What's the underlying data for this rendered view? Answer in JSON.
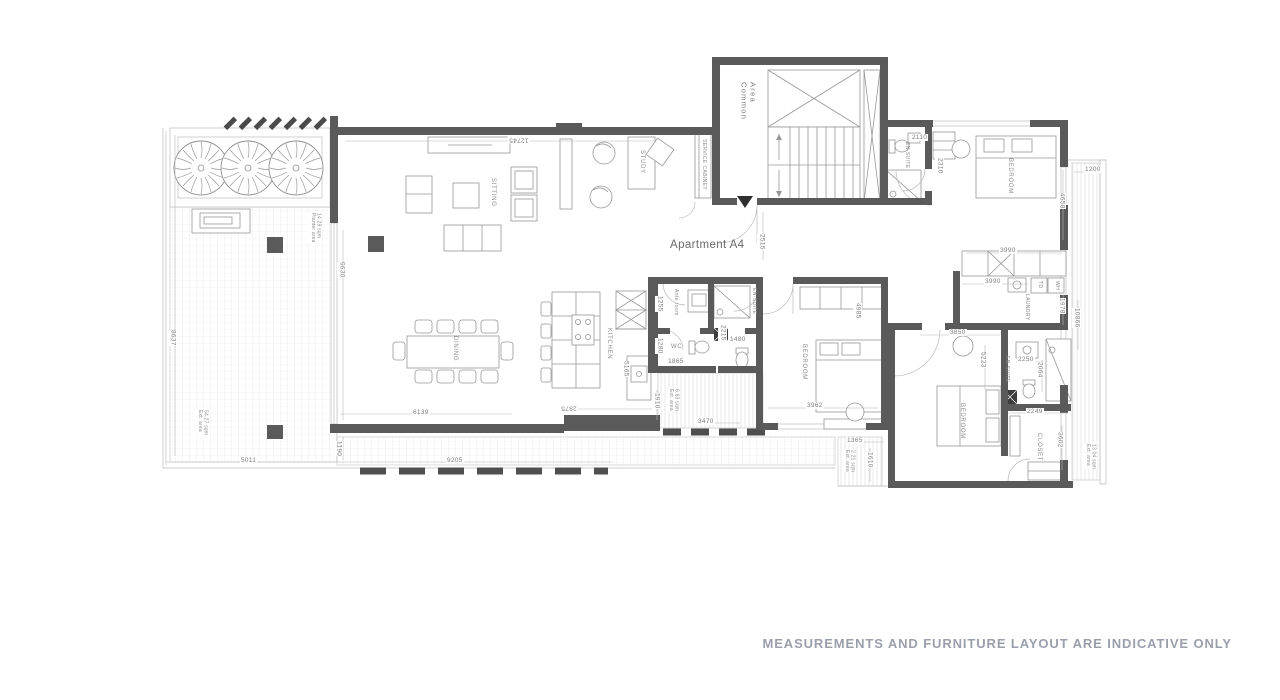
{
  "title": "Apartment A4",
  "disclaimer": "MEASUREMENTS AND FURNITURE LAYOUT ARE INDICATIVE ONLY",
  "colors": {
    "wall": "#5a5a5a",
    "furniture_line": "#979797",
    "hatch_line": "#e2e2e2",
    "dimension_text": "#7c7c7c",
    "disclaimer_text": "#9aa0ab"
  },
  "rooms": {
    "common_area_line1": "Common",
    "common_area_line2": "Area",
    "service_cabinet": "SERVICE CABINET",
    "study": "STUDY",
    "sitting": "SITTING",
    "dining": "DINING",
    "kitchen": "KITCHEN",
    "ante_room": "Ante room",
    "wc": "WC",
    "ensuite_mid": "EN-SUITE",
    "bedroom_mid": "BEDROOM",
    "ensuite_top_right": "EN-SUITE",
    "bedroom_top_right": "BEDROOM",
    "laundry": "LAUNDRY",
    "tumble_dryer": "TD",
    "water_heater": "WH",
    "ensuite_bottom_right": "EN-SUITE",
    "bedroom_bottom_right": "BEDROOM",
    "closet": "CLOSET"
  },
  "areas": {
    "planter": {
      "line1": "Planter area",
      "line2": "14.29 sqm"
    },
    "terrace": {
      "line1": "Ext. area",
      "line2": "54.27 sqm"
    },
    "balcony_center": {
      "line1": "Ext. area",
      "line2": "6.63 sqm"
    },
    "balcony_bedroom": {
      "line1": "Ext. area",
      "line2": "2.21 sqm"
    },
    "balcony_right": {
      "line1": "Ext. area",
      "line2": "13.04 sqm"
    }
  },
  "dimensions": {
    "living_top": "12745",
    "living_left": "9630",
    "terrace_left": "8637",
    "terrace_bottom_left": "5011",
    "terrace_bottom_gap": "1190",
    "terrace_bottom_right": "9205",
    "living_bottom": "6139",
    "kitchen_bottom": "2875",
    "balcony_center_height": "1910",
    "balcony_center_width": "3470",
    "kitchen_height": "5165",
    "ante_room_width": "1255",
    "wc_width": "1280",
    "wc_bottom": "1865",
    "ensuite_mid_height": "2215",
    "ensuite_mid_width": "1480",
    "entry_corridor": "2515",
    "bedroom_mid_height": "4985",
    "bedroom_mid_width": "3962",
    "balcony_bedroom_width": "1365",
    "balcony_bedroom_height": "1610",
    "ensuite_top_width": "2110",
    "ensuite_top_height": "2310",
    "bedroom_top_height": "4658",
    "balcony_right_width": "1200",
    "wardrobe_top": "3990",
    "laundry_width": "3990",
    "laundry_height": "1978",
    "balcony_right_height": "10866",
    "bedroom_br_top": "3850",
    "bedroom_br_height": "5223",
    "ensuite_br_width": "2250",
    "ensuite_br_height": "2064",
    "closet_width": "2249",
    "closet_height": "3602"
  }
}
